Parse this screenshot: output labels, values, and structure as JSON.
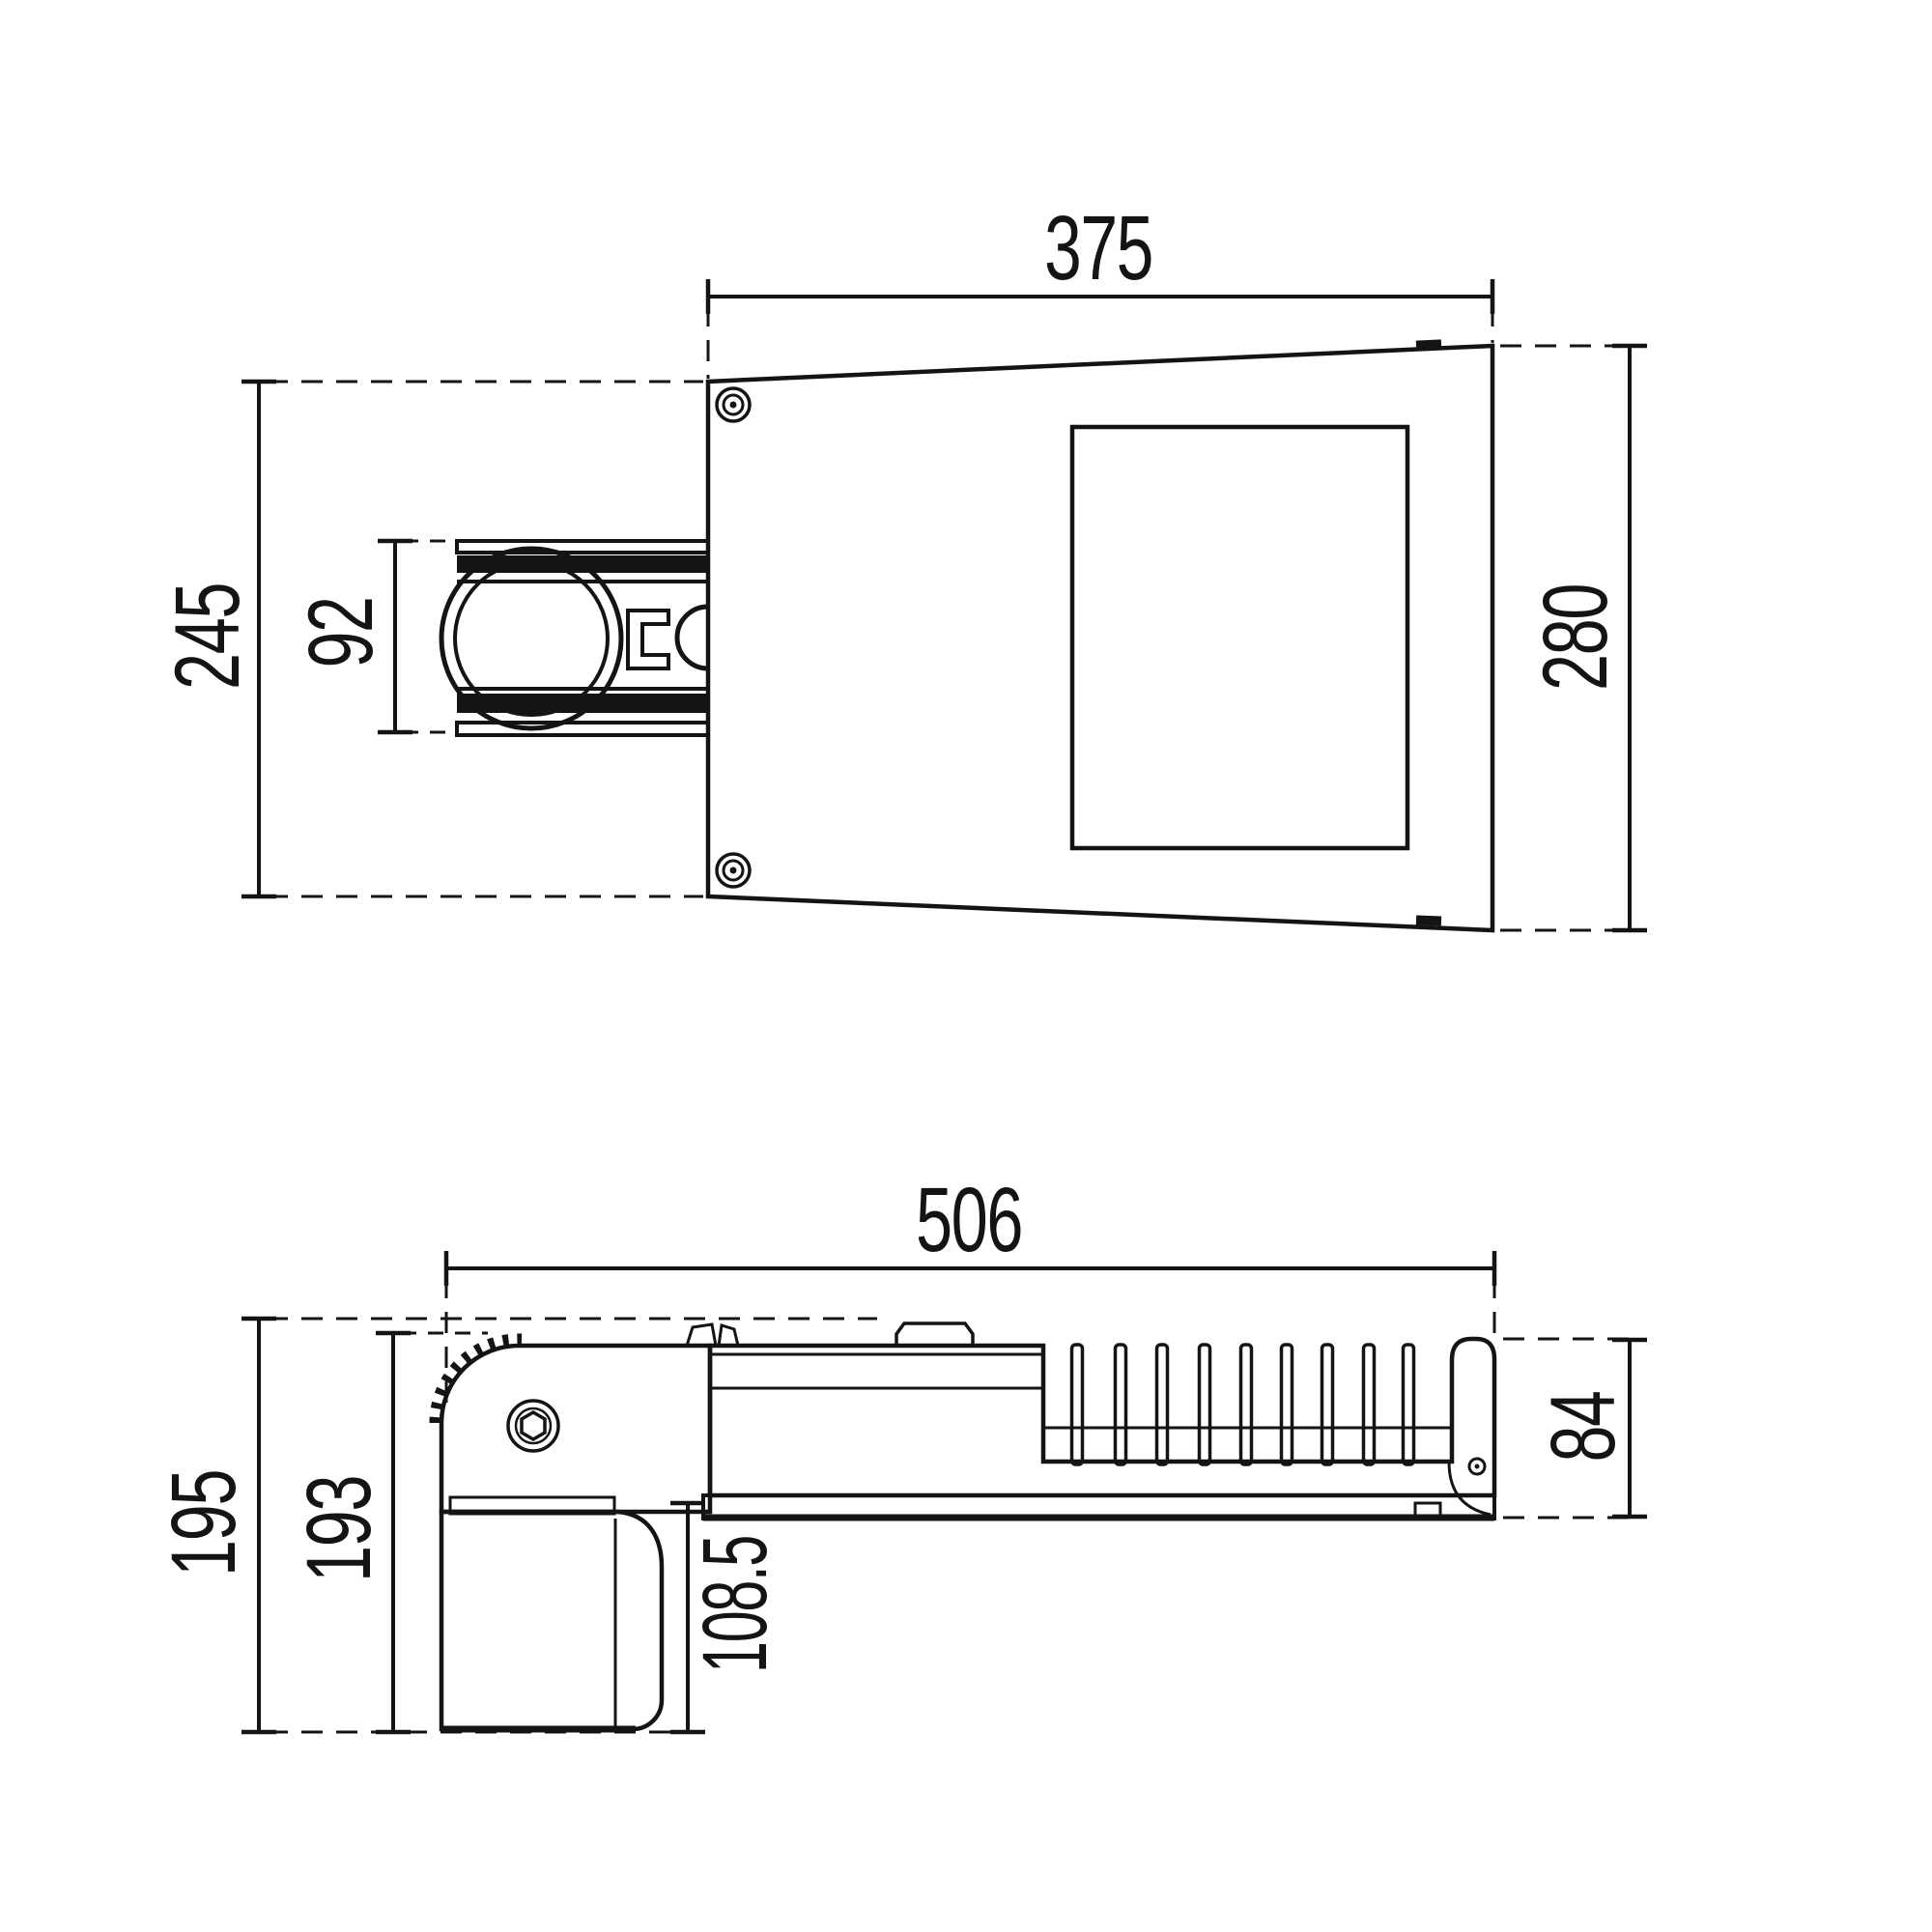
{
  "drawing": {
    "type": "technical-dimension-drawing",
    "part": "pole-mounted street luminaire, top view and side view",
    "line_color": "#141414",
    "part_fill_color": "#c9cacb",
    "views": {
      "top": {
        "dims": {
          "body_width": "375",
          "body_height": "280",
          "overall_height": "245",
          "bracket_height": "92"
        }
      },
      "side": {
        "dims": {
          "overall_length": "506",
          "overall_height": "195",
          "clamp_height": "193",
          "drop_below_housing": "108.5",
          "housing_height": "84"
        }
      }
    }
  }
}
